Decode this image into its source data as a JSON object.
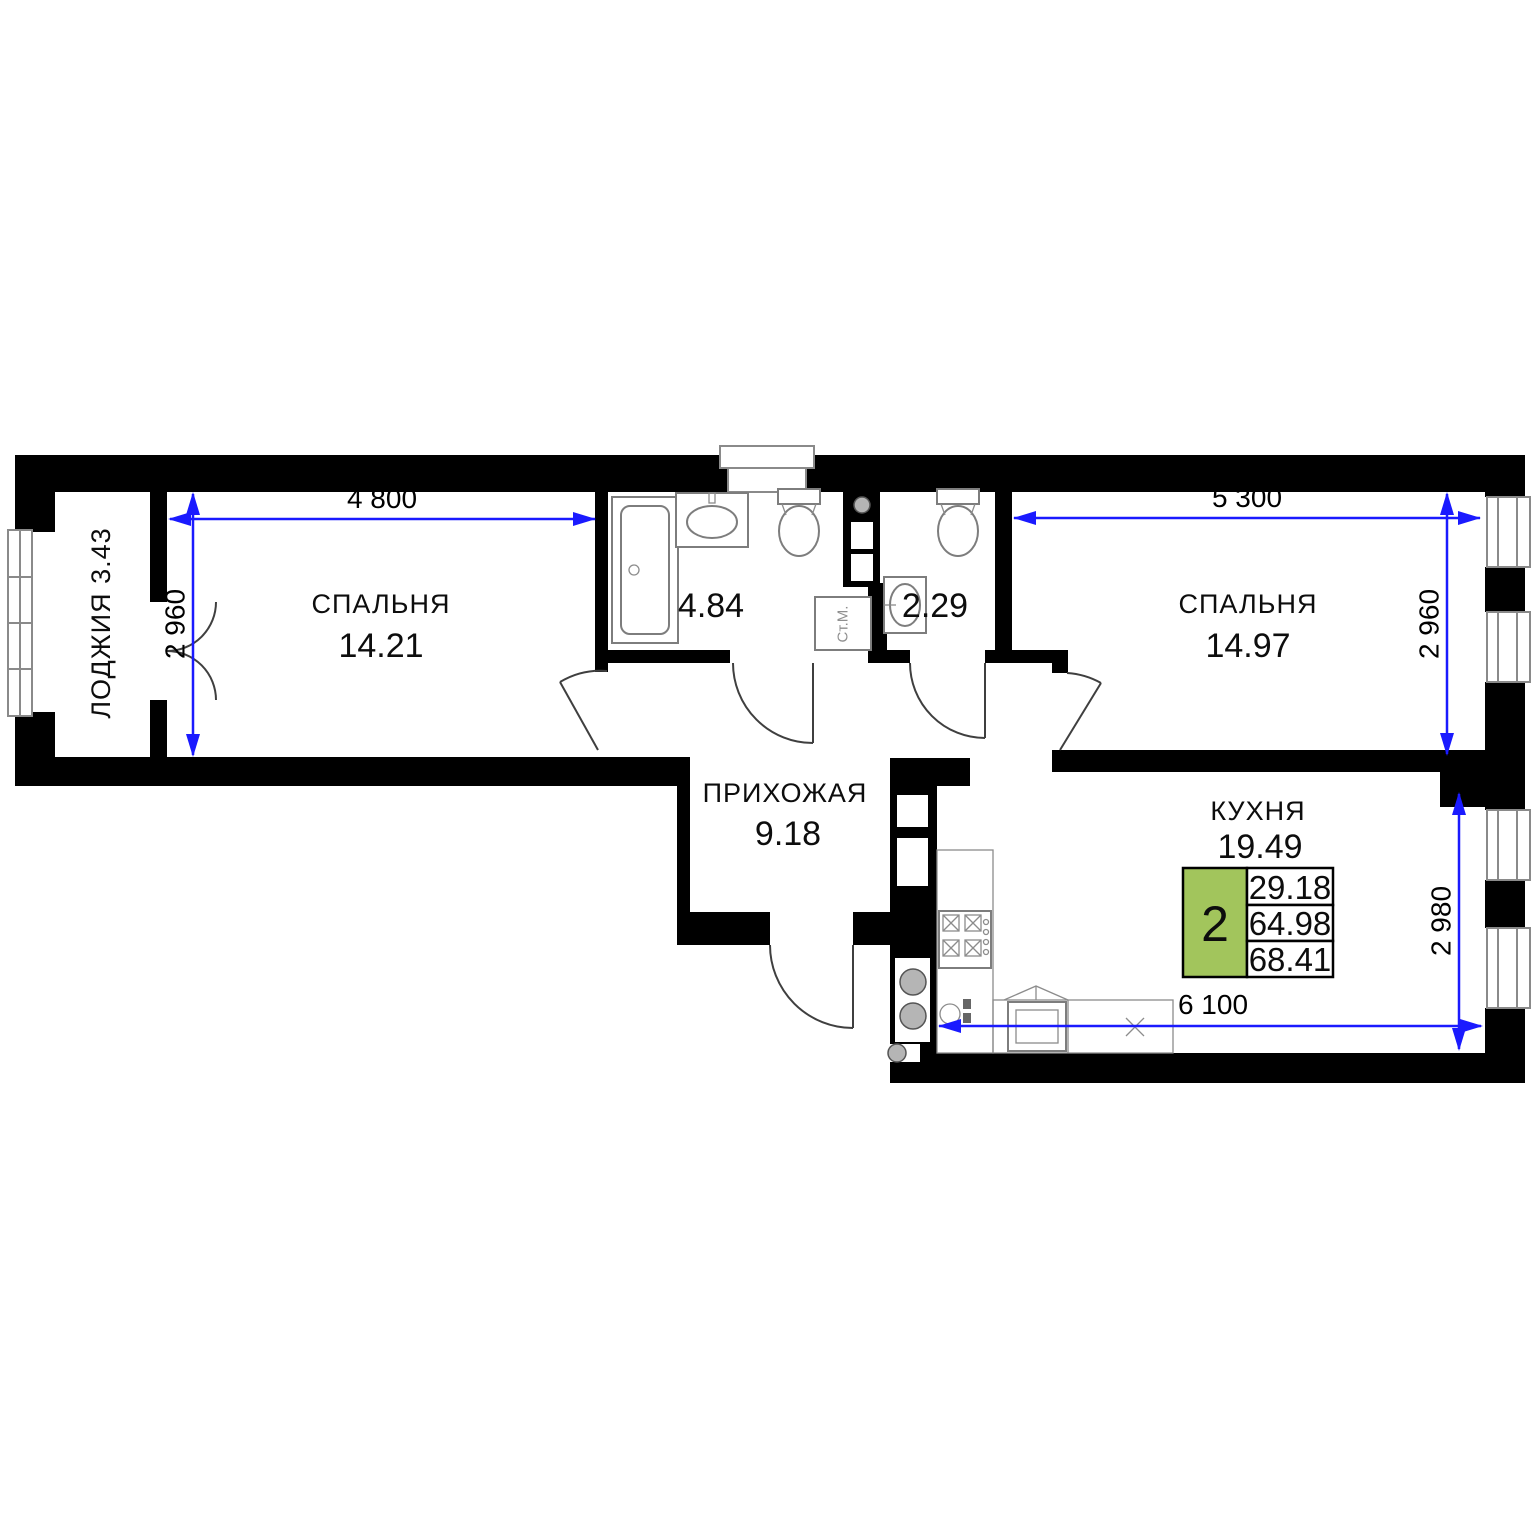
{
  "rooms": {
    "loggia": {
      "label": "ЛОДЖИЯ 3.43"
    },
    "bedroom1": {
      "name": "СПАЛЬНЯ",
      "area": "14.21"
    },
    "bathroom": {
      "area": "4.84"
    },
    "wc": {
      "area": "2.29"
    },
    "bedroom2": {
      "name": "СПАЛЬНЯ",
      "area": "14.97"
    },
    "hallway": {
      "name": "ПРИХОЖАЯ",
      "area": "9.18"
    },
    "kitchen": {
      "name": "КУХНЯ",
      "area": "19.49"
    }
  },
  "dimensions": {
    "bedroom1_width": "4 800",
    "bedroom1_depth": "2 960",
    "bedroom2_width": "5 300",
    "bedroom2_depth": "2 960",
    "kitchen_width": "6 100",
    "kitchen_depth": "2 980"
  },
  "info_badge": {
    "room_count": "2",
    "living_area": "29.18",
    "apartment_area": "64.98",
    "total_area": "68.41"
  },
  "fixtures": {
    "washing_machine": "Ст.М."
  },
  "colors": {
    "wall": "#000000",
    "dimension_blue": "#1a1aff",
    "badge_green": "#a2c55c",
    "fixture_gray": "#7d7d7d"
  }
}
